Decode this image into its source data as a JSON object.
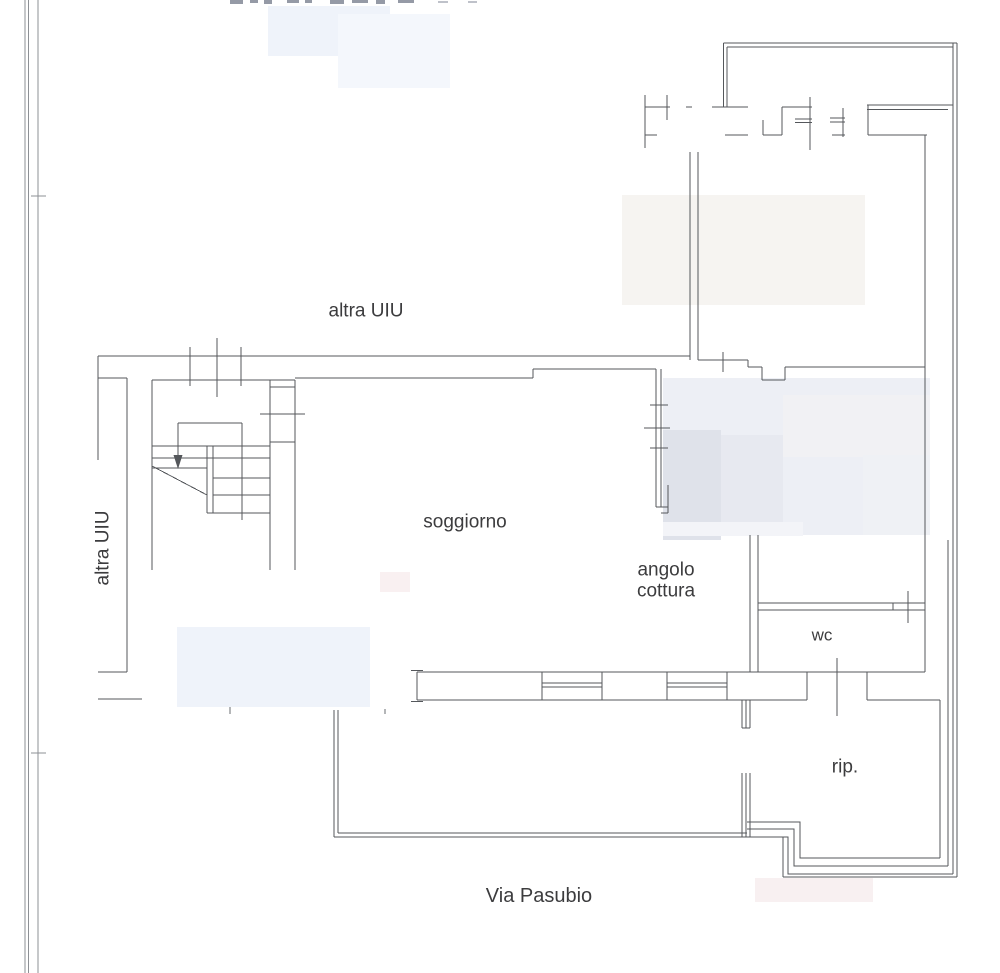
{
  "document": {
    "type": "floor-plan",
    "background": "#ffffff"
  },
  "colors": {
    "wall_line": "#54575b",
    "page_border": "#8d9095",
    "label_text": "#3c3c3e",
    "redaction_dark": "#959aa6",
    "redaction_blur_cool": "#eceef5",
    "redaction_blur_warm": "#f6f4f1"
  },
  "labels": {
    "other_unit_top": "altra UIU",
    "other_unit_left": "altra UIU",
    "living_room": "soggiorno",
    "kitchen_line1": "angolo",
    "kitchen_line2": "cottura",
    "toilet": "wc",
    "storage": "rip.",
    "street": "Via Pasubio"
  }
}
